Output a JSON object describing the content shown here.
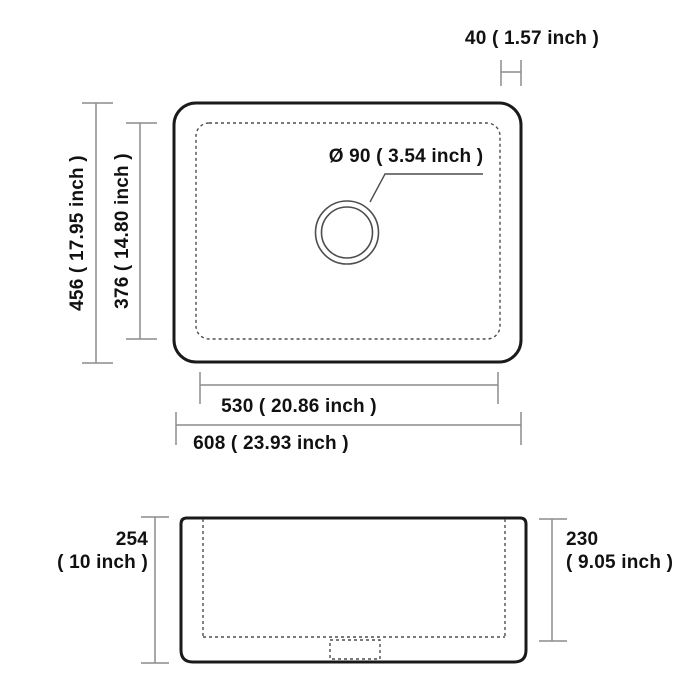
{
  "diagram": {
    "type": "technical-dimension-drawing",
    "subject": "single-bowl farmhouse kitchen sink, top view and side view",
    "units": "millimeters with inch conversion"
  },
  "colors": {
    "background": "#ffffff",
    "sink_outline": "#1a1a1a",
    "dimension_lines": "#8c8c8c",
    "dashed_lines": "#4d4d4d",
    "text": "#111111"
  },
  "top_view": {
    "drain": {
      "label": "Ø 90 ( 3.54 inch )",
      "diameter_mm": 90,
      "diameter_inch": 3.54
    },
    "dims": {
      "rim_offset": {
        "label": "40 ( 1.57 inch )",
        "mm": 40,
        "inch": 1.57
      },
      "outer_height": {
        "label": "456 ( 17.95 inch )",
        "mm": 456,
        "inch": 17.95
      },
      "inner_height": {
        "label": "376 ( 14.80 inch )",
        "mm": 376,
        "inch": 14.8
      },
      "inner_width": {
        "label": "530 ( 20.86 inch )",
        "mm": 530,
        "inch": 20.86
      },
      "outer_width": {
        "label": "608 ( 23.93 inch )",
        "mm": 608,
        "inch": 23.93
      }
    }
  },
  "side_view": {
    "dims": {
      "outer_depth": {
        "value": "254",
        "inch_label": "( 10 inch )",
        "mm": 254,
        "inch": 10
      },
      "inner_depth": {
        "value": "230",
        "inch_label": "( 9.05 inch )",
        "mm": 230,
        "inch": 9.05
      }
    }
  }
}
